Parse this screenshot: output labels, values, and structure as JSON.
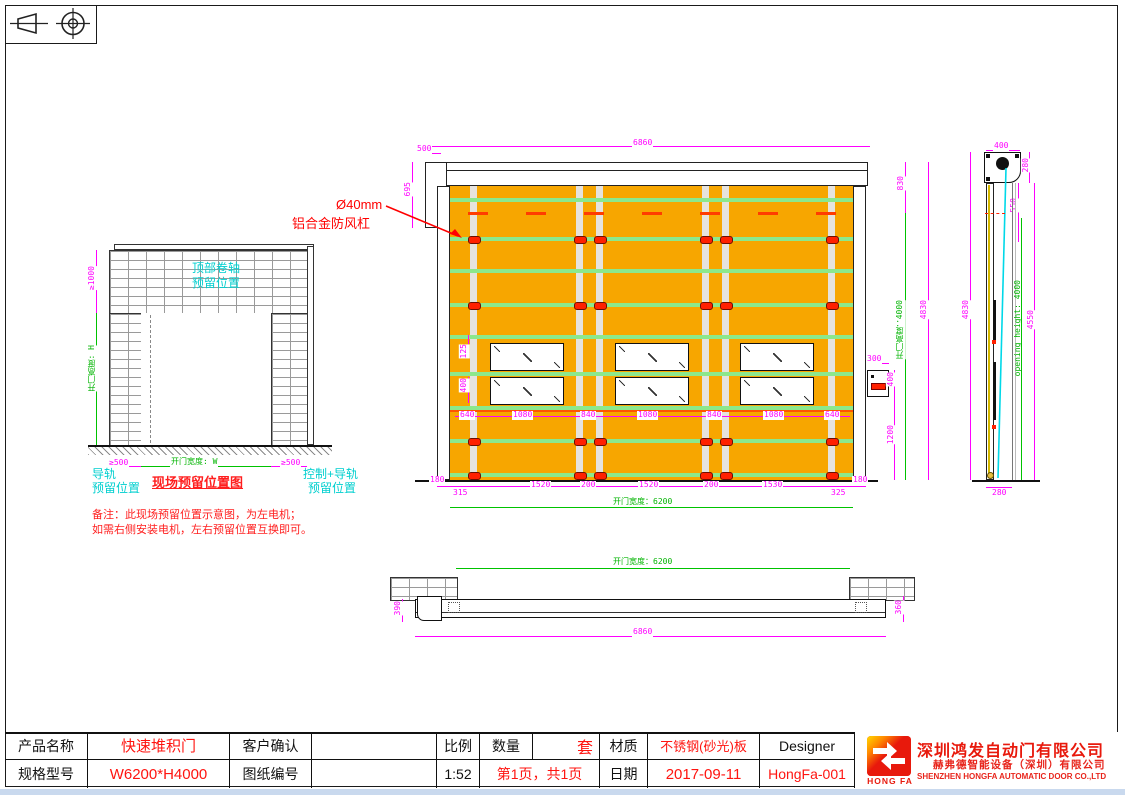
{
  "site_diagram": {
    "dim_top_clearance": "≥1000",
    "label_top_roller_line1": "顶部卷轴",
    "label_top_roller_line2": "预留位置",
    "label_opening_height": "开门高度: H",
    "dim_left_clearance": "≥500",
    "label_opening_width": "开门宽度: W",
    "dim_right_clearance": "≥500",
    "label_rail_line1": "导轨",
    "label_rail_line2": "预留位置",
    "title": "现场预留位置图",
    "label_control_line1": "控制+导轨",
    "label_control_line2": "预留位置",
    "note_line1": "备注：此现场预留位置示意图，为左电机；",
    "note_line2": "如需右侧安装电机，左右预留位置互换即可。"
  },
  "main_view": {
    "annotation_line1": "Ø40mm",
    "annotation_line2": "铝合金防风杠",
    "dim_total_width": "6860",
    "dim_left_offset": "500",
    "dim_header_height": "695",
    "dim_top_to_bar": "830",
    "dim_total_height": "4830",
    "dim_opening_height": "开门高度：4000",
    "dim_box_width": "300",
    "dim_box_height": "400",
    "dim_box_to_floor": "1200",
    "dim_window_gap": "125",
    "dim_window_height": "400",
    "window_dims": [
      "640",
      "1080",
      "840",
      "1080",
      "840",
      "1080",
      "640"
    ],
    "strap_dims": [
      "180",
      "315",
      "1520",
      "200",
      "1520",
      "200",
      "1530",
      "325",
      "180"
    ],
    "dim_opening_width": "开门宽度：6200"
  },
  "side_view": {
    "dim_top_width": "400",
    "dim_roller_height": "280",
    "dim_top_offset": "550",
    "dim_total_height": "4830",
    "dim_opening_height": "opening height: 4000",
    "dim_rail_height": "4550",
    "dim_bottom_width": "280"
  },
  "plan_view": {
    "dim_opening_width": "开门宽度：6200",
    "dim_left_depth": "390",
    "dim_right_depth": "360",
    "dim_total_width": "6860"
  },
  "title_block": {
    "product_name_label": "产品名称",
    "product_name": "快速堆积门",
    "customer_label": "客户确认",
    "scale_label": "比例",
    "scale_value": "1:52",
    "qty_label": "数量",
    "qty_value": "套",
    "material_label": "材质",
    "material_value": "不锈钢(砂光)板",
    "designer_label": "Designer",
    "designer_value": "HongFa-001",
    "model_label": "规格型号",
    "model_value": "W6200*H4000",
    "drawing_no_label": "图纸编号",
    "pages_value": "第1页，共1页",
    "date_label": "日期",
    "date_value": "2017-09-11"
  },
  "logo": {
    "short_name": "HONG FA",
    "company_cn": "深圳鸿发自动门有限公司",
    "company_cn2": "赫弗德智能设备（深圳）有限公司",
    "company_en": "SHENZHEN HONGFA AUTOMATIC DOOR CO.,LTD"
  },
  "colors": {
    "dim_magenta": "#FF00FF",
    "dim_green": "#00C300",
    "label_cyan": "#00CFCF",
    "accent_red": "#FF1E1E",
    "curtain_orange": "#F7A600",
    "bar_green": "#8CE88C",
    "strap_gray": "#E6E3DE",
    "brand_red": "#E8190C"
  }
}
